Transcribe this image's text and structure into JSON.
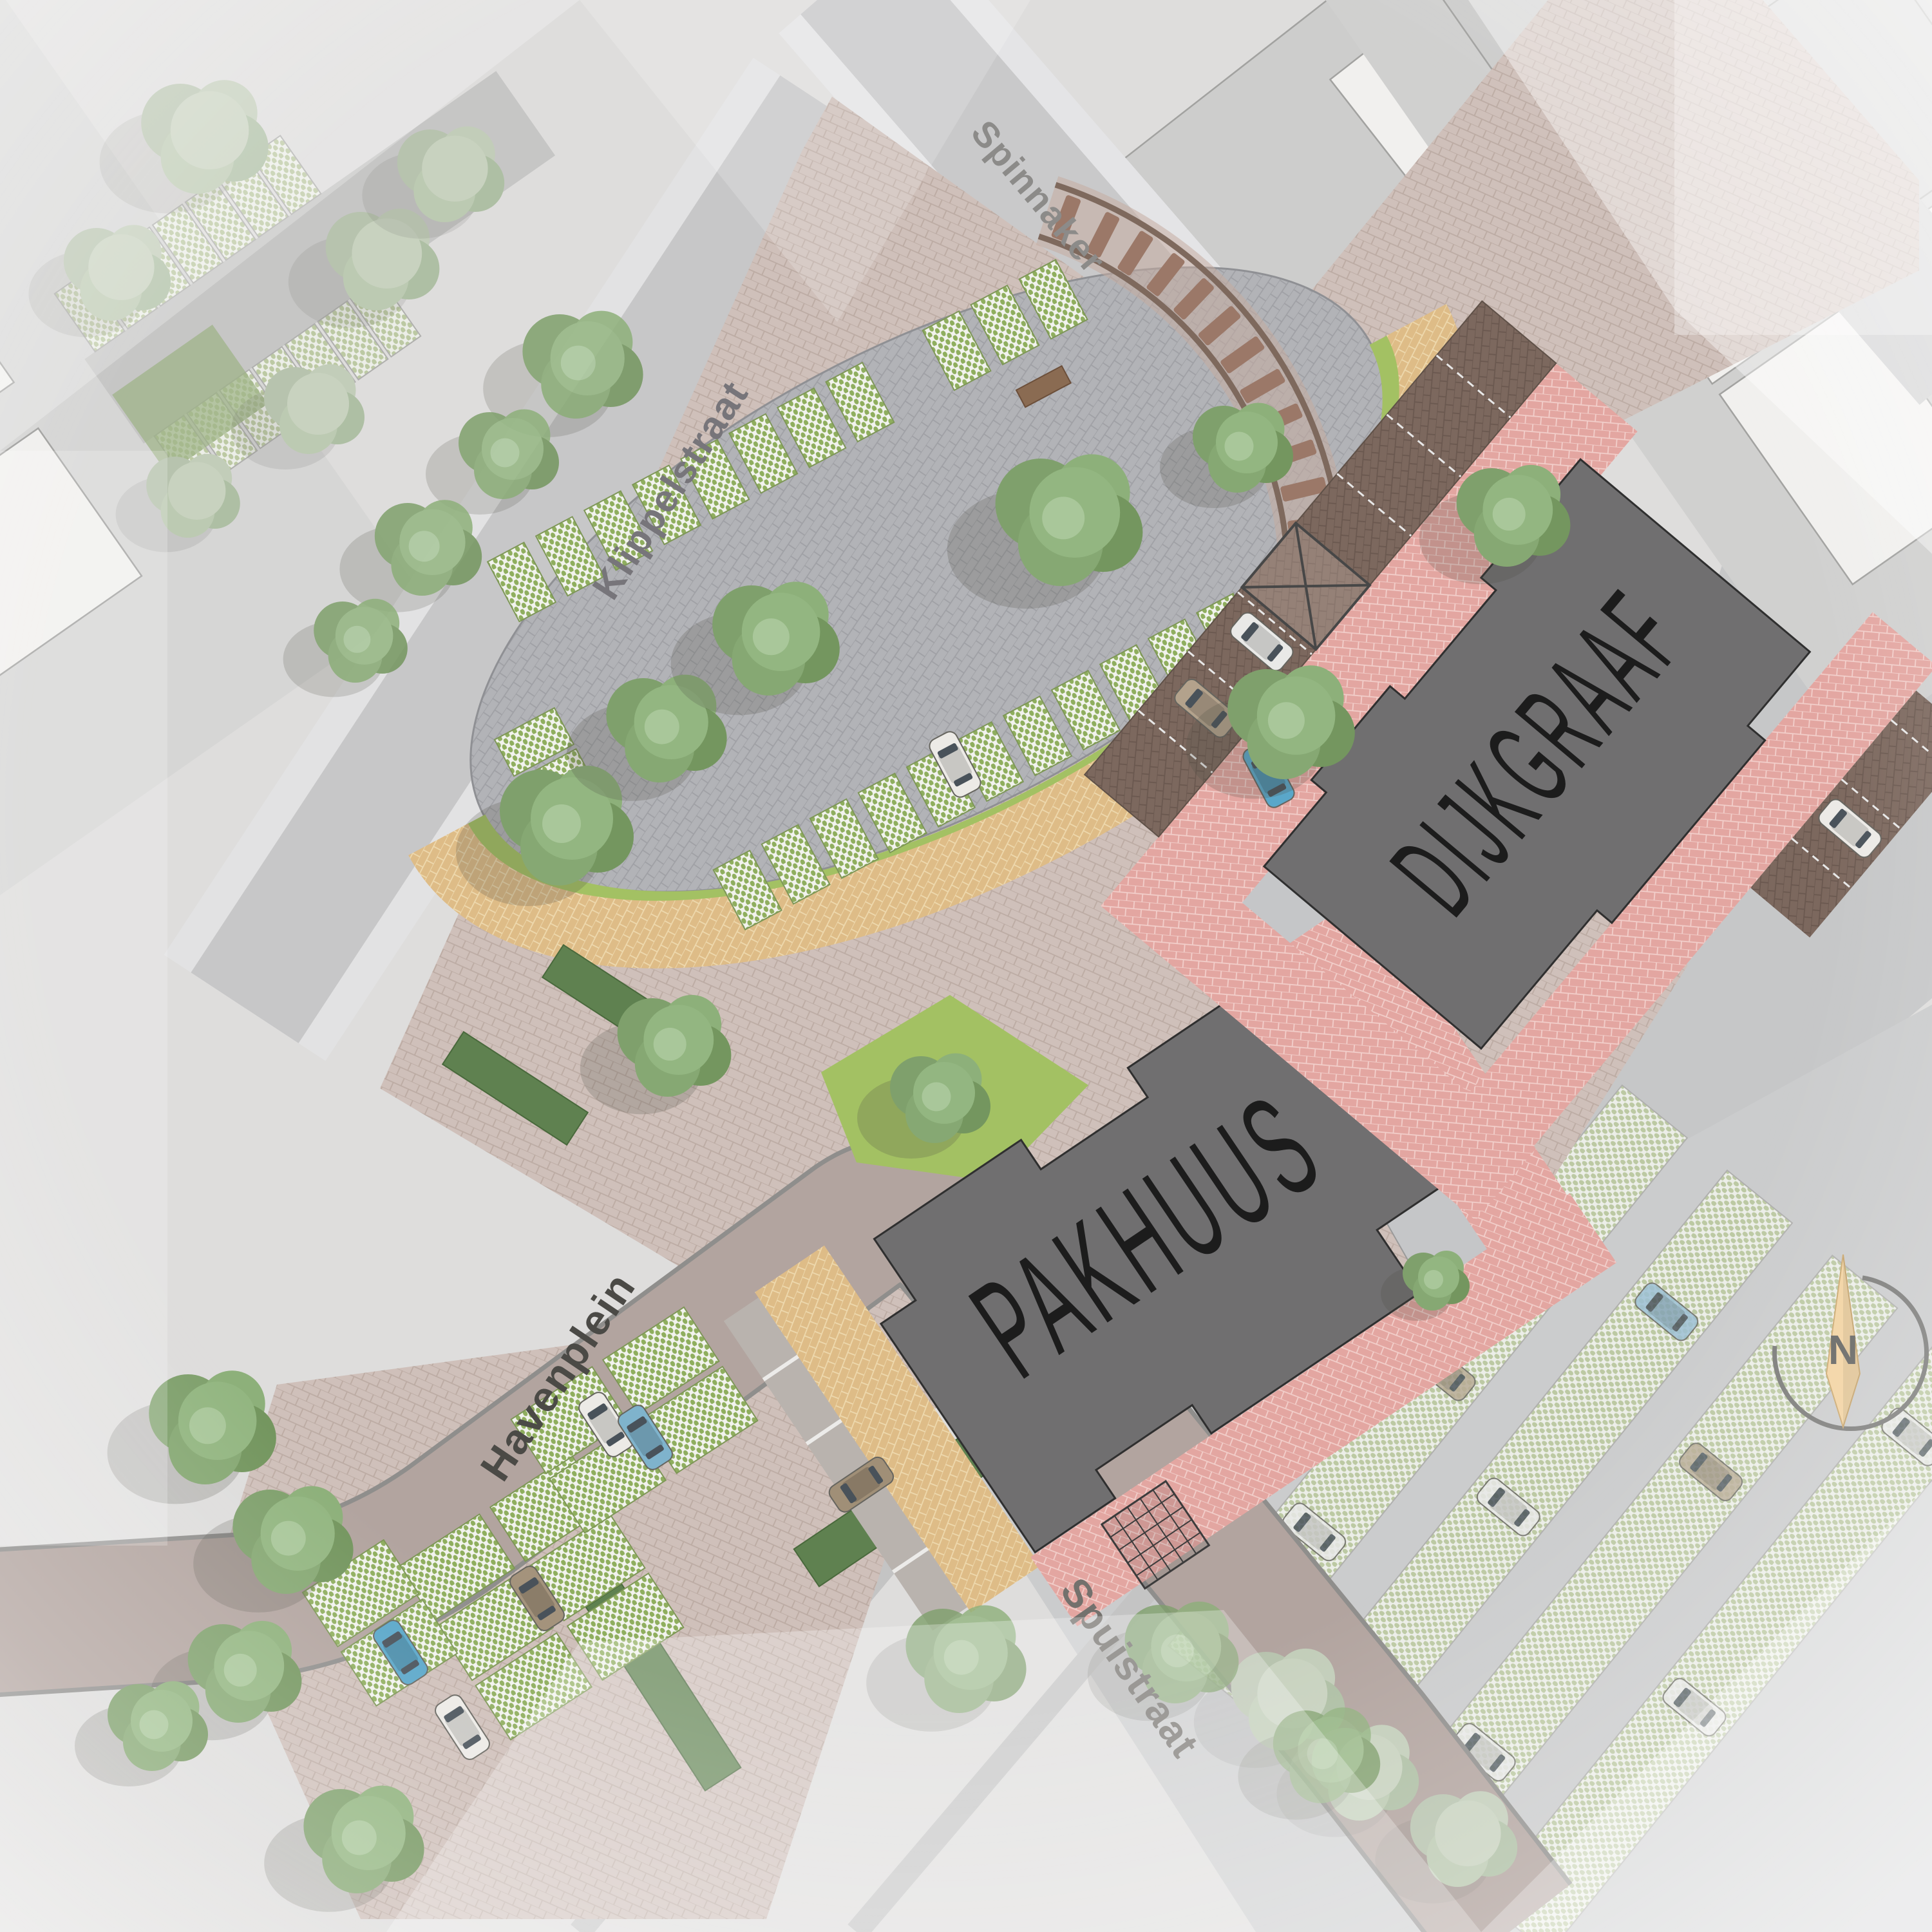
{
  "plan": {
    "title": "Havenplein urban landscape site plan",
    "streets": [
      {
        "name": "Spinnaker"
      },
      {
        "name": "Klippelstraat"
      },
      {
        "name": "Havenplein"
      },
      {
        "name": "Spuistraat"
      }
    ],
    "buildings": [
      {
        "name": "PAKHUUS"
      },
      {
        "name": "DIJKGRAAF"
      }
    ],
    "compass": {
      "north_label": "N"
    }
  },
  "colors": {
    "paving_dusty": "#cfc0ba",
    "paving_pink": "#e3a6a1",
    "paving_gray": "#b2b3b7",
    "paving_tan": "#debc87",
    "paving_brown": "#7c685e",
    "building": "#706f70",
    "building_label": "#1c1c1c",
    "lawn": "#a3c163",
    "stall_green": "#8fae5e",
    "hedge": "#5f8150",
    "tree": "#7fa06c",
    "road_focus": "#b2a49f",
    "road_muted": "#c8c8c9",
    "parcel_white": "#f1f0ee",
    "parcel_gray": "#cdcdcc",
    "north_arrow": "#f2d2a0",
    "label_dark": "#4b4a46",
    "label_muted": "#8c8b89"
  }
}
